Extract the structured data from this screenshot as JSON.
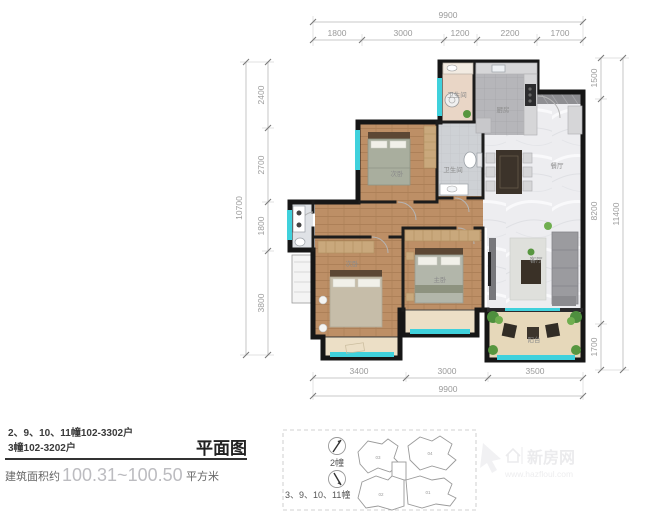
{
  "dims": {
    "top": {
      "total": "9900",
      "segments": [
        "1800",
        "3000",
        "1200",
        "2200",
        "1700"
      ]
    },
    "left": {
      "total": "10700",
      "segments": [
        "2400",
        "2700",
        "1800",
        "3800"
      ]
    },
    "right": {
      "total": "11400",
      "segments": [
        "1500",
        "8200",
        "1700"
      ]
    },
    "bottom": {
      "total": "9900",
      "segments": [
        "3400",
        "3000",
        "3500"
      ]
    }
  },
  "rooms": {
    "kitchen": "厨房",
    "dining": "餐厅",
    "living": "客厅",
    "master": "主卧",
    "bed2": "次卧",
    "bed3": "次卧",
    "bath1": "卫生间",
    "bath2": "卫生间",
    "balcony": "阳台"
  },
  "title_block": {
    "units_line1": "2、9、10、11幢102-3302户",
    "units_line2": "3幢102-3202户",
    "plan_label": "平面图",
    "area_prefix": "建筑面积约",
    "area_value": "100.31~100.50",
    "area_suffix": "平方米"
  },
  "legend": {
    "compass_top_label": "2幢",
    "compass_bottom_label": "3、9、10、11幢",
    "site_buildings": [
      "03",
      "04",
      "02",
      "01"
    ]
  },
  "watermark": {
    "brand": "新房网",
    "url": "www.hazfloul.com"
  },
  "colors": {
    "wall": "#161616",
    "wood_floor": "#bd8f66",
    "marble_floor": "#ededf0",
    "window_glass": "#3fd1dc",
    "plant_green": "#57963f",
    "balcony_beige": "#e6d8ba"
  }
}
